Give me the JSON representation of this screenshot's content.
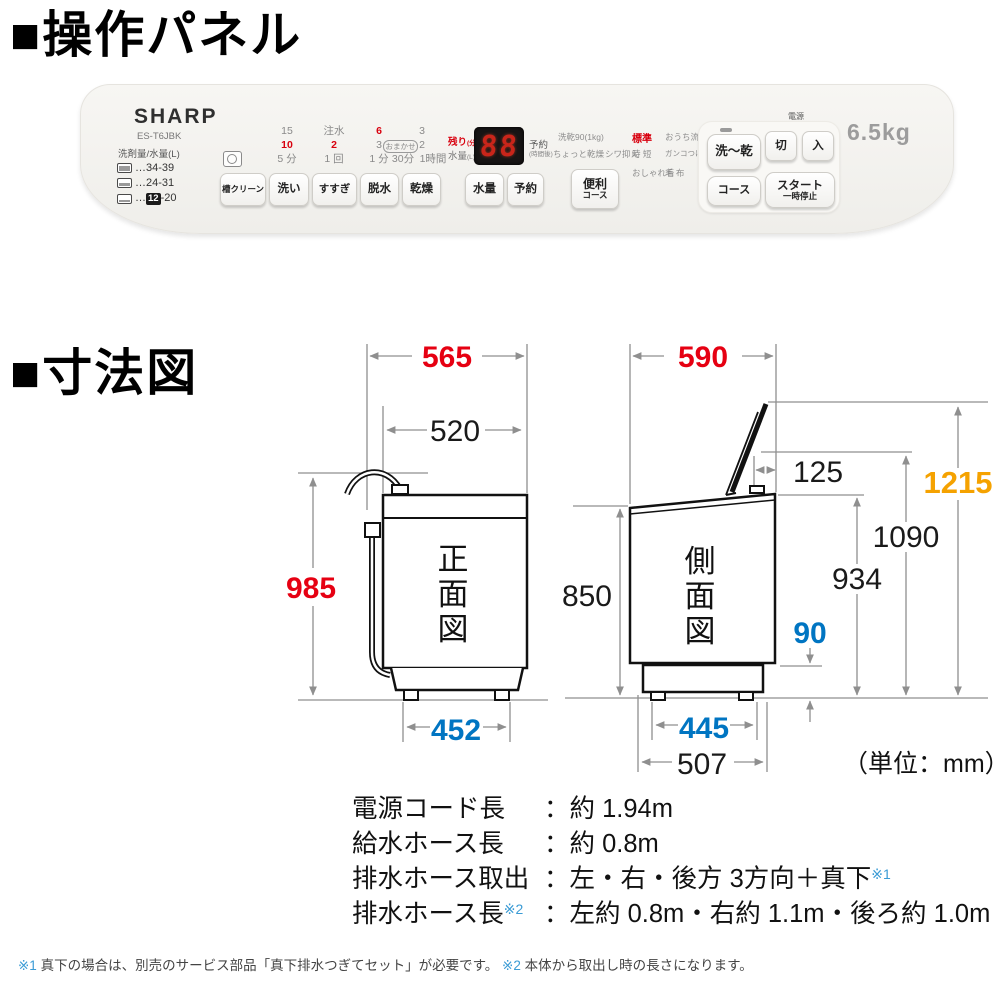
{
  "page": {
    "section1_title": "■操作パネル",
    "section2_title": "■寸法図"
  },
  "panel": {
    "brand": "SHARP",
    "model": "ES-T6JBK",
    "capacity": "6.5kg",
    "power_label": "電源",
    "detergent": {
      "title": "洗剤量/水量(L)",
      "rows": [
        {
          "dots": "…",
          "range": "34-39"
        },
        {
          "dots": "…",
          "range": "24-31"
        },
        {
          "dots": "…",
          "badge": "12",
          "range": "-20"
        }
      ]
    },
    "programs": {
      "wash": [
        "15",
        "10",
        "5 分"
      ],
      "rinse": [
        "注水",
        "2",
        "1 回"
      ],
      "spin": [
        "6",
        "3",
        "1 分"
      ],
      "dry_top": "3",
      "dry_pill": "おまかせ",
      "dry_mid": "2",
      "dry_b1": "30分",
      "dry_b2": "1時間"
    },
    "display": {
      "remain": "残り",
      "remain_u": "(分)",
      "water": "水量",
      "water_u": "(L)",
      "digits": "88",
      "reserve": "予約",
      "reserve_u": "(時間後)"
    },
    "buttons": {
      "tub_clean": "槽クリーン",
      "wash": "洗い",
      "rinse": "すすぎ",
      "spin": "脱水",
      "dry": "乾燥",
      "water": "水量",
      "reserve": "予約",
      "handy1": "便利",
      "handy2": "コース",
      "wash_dry": "洗〜乾",
      "power_off": "切",
      "power_on": "入",
      "course": "コース",
      "start": "スタート",
      "pause": "一時停止"
    },
    "courses": {
      "c1": [
        "洗乾90(1kg)",
        "ちょっと乾燥",
        "シワ抑え"
      ],
      "c2": [
        "標準",
        "時 短",
        "おしゃれ着"
      ],
      "c3": [
        "おうち流",
        "ガンコつけおき",
        "毛 布"
      ]
    }
  },
  "diagram": {
    "front": {
      "label": [
        "正",
        "面",
        "図"
      ],
      "w_total": "565",
      "w_body": "520",
      "h": "985",
      "feet": "452"
    },
    "side": {
      "label": [
        "側",
        "面",
        "図"
      ],
      "d_total": "590",
      "lid": "125",
      "h_total": "1215",
      "h_1090": "1090",
      "h_934": "934",
      "h_body": "850",
      "gap": "90",
      "feet": "445",
      "d_base": "507"
    },
    "unit": "（単位：mm）"
  },
  "specs": {
    "rows": [
      {
        "label": "電源コード長",
        "sup": "",
        "value": "：約 1.94m",
        "vsup": ""
      },
      {
        "label": "給水ホース長",
        "sup": "",
        "value": "：約 0.8m",
        "vsup": ""
      },
      {
        "label": "排水ホース取出",
        "sup": "",
        "value": "：左・右・後方 3方向＋真下",
        "vsup": "※1"
      },
      {
        "label": "排水ホース長",
        "sup": "※2",
        "value": "：左約 0.8m・右約 1.1m・後ろ約 1.0m",
        "vsup": ""
      }
    ]
  },
  "footnote": {
    "m1": "※1",
    "t1": "真下の場合は、別売のサービス部品「真下排水つぎてセット」が必要です。",
    "m2": "※2",
    "t2": "本体から取出し時の長さになります。"
  },
  "colors": {
    "red": "#e60012",
    "blue": "#0075c2",
    "orange": "#f5a200"
  }
}
